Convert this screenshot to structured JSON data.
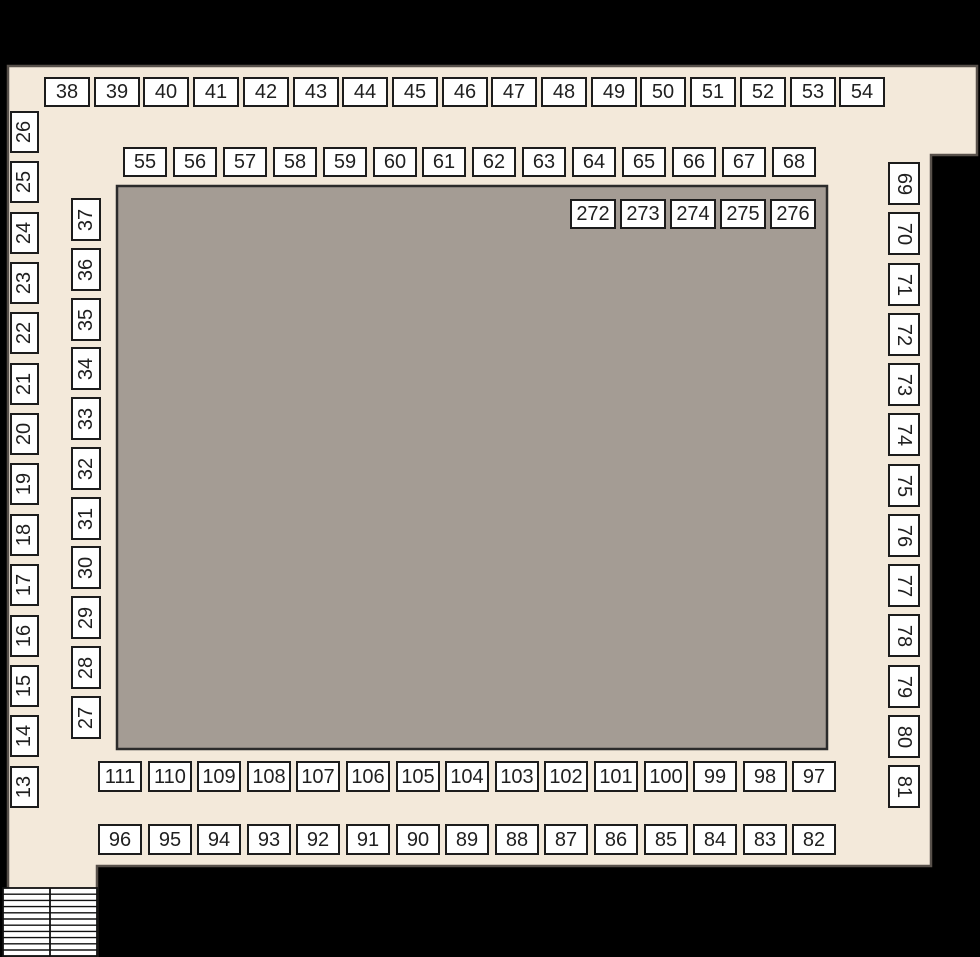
{
  "colors": {
    "background": "#000000",
    "floor": "#f3e9da",
    "floor_outline": "#57504a",
    "hall_fill": "#a49c94",
    "hall_outline": "#2b2b2b",
    "booth_fill": "#ffffff",
    "booth_border": "#1c1c1c",
    "booth_text": "#1f1f1f",
    "stairs_fill": "#ffffff",
    "stairs_line": "#111111"
  },
  "rows": {
    "top_outer": [
      "38",
      "39",
      "40",
      "41",
      "42",
      "43",
      "44",
      "45",
      "46",
      "47",
      "48",
      "49",
      "50",
      "51",
      "52",
      "53",
      "54"
    ],
    "top_inner": [
      "55",
      "56",
      "57",
      "58",
      "59",
      "60",
      "61",
      "62",
      "63",
      "64",
      "65",
      "66",
      "67",
      "68"
    ],
    "left_outer": [
      "26",
      "25",
      "24",
      "23",
      "22",
      "21",
      "20",
      "19",
      "18",
      "17",
      "16",
      "15",
      "14",
      "13"
    ],
    "left_inner": [
      "37",
      "36",
      "35",
      "34",
      "33",
      "32",
      "31",
      "30",
      "29",
      "28",
      "27"
    ],
    "right_column": [
      "69",
      "70",
      "71",
      "72",
      "73",
      "74",
      "75",
      "76",
      "77",
      "78",
      "79",
      "80",
      "81"
    ],
    "hall_top": [
      "272",
      "273",
      "274",
      "275",
      "276"
    ],
    "bottom_inner": [
      "111",
      "110",
      "109",
      "108",
      "107",
      "106",
      "105",
      "104",
      "103",
      "102",
      "101",
      "100",
      "99",
      "98",
      "97"
    ],
    "bottom_outer": [
      "96",
      "95",
      "94",
      "93",
      "92",
      "91",
      "90",
      "89",
      "88",
      "87",
      "86",
      "85",
      "84",
      "83",
      "82"
    ]
  }
}
